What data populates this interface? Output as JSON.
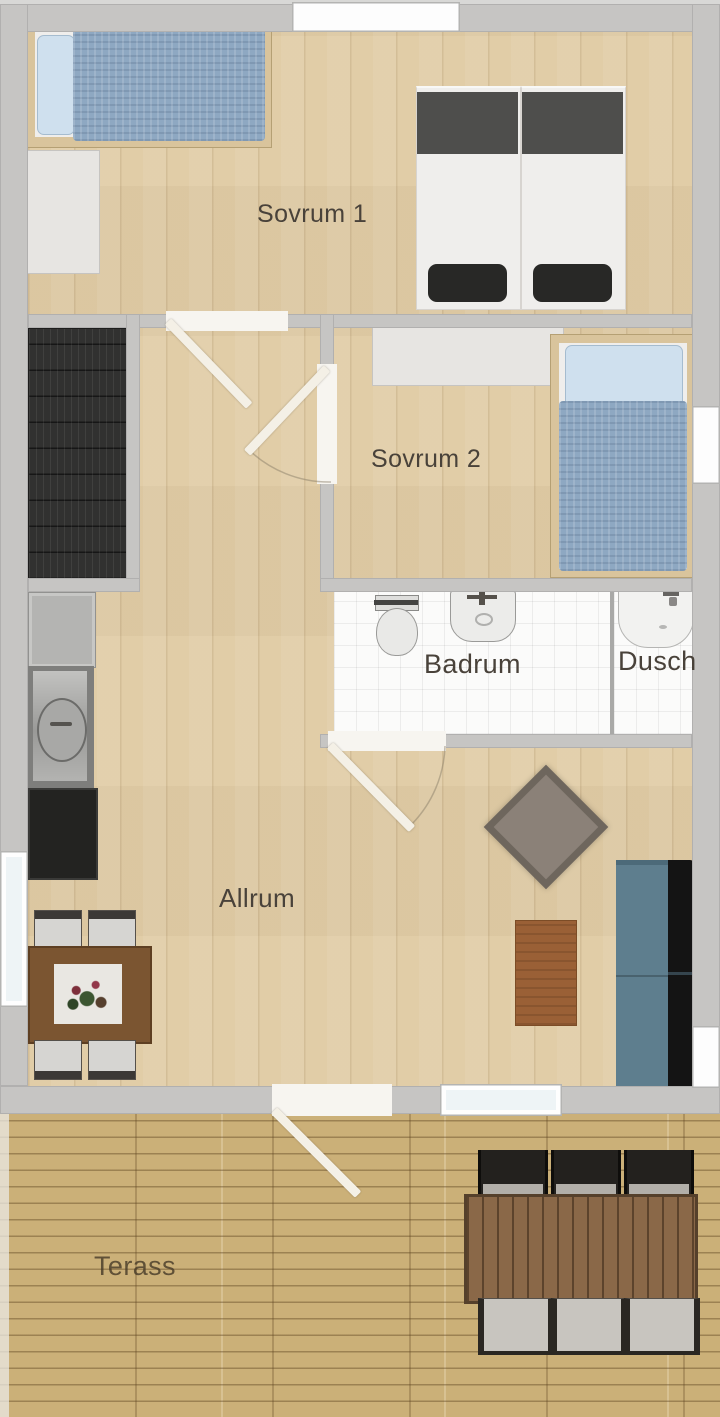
{
  "plan_title": "Apartment floor plan",
  "rooms": {
    "sovrum1": {
      "label": "Sovrum 1"
    },
    "sovrum2": {
      "label": "Sovrum 2"
    },
    "badrum": {
      "label": "Badrum"
    },
    "dusch": {
      "label": "Dusch"
    },
    "allrum": {
      "label": "Allrum"
    },
    "terass": {
      "label": "Terass"
    }
  },
  "colors": {
    "wall_gray": "#c6c5c3",
    "floor_wood": "#e1cda7",
    "terrace_wood": "#cbb078",
    "bathroom_tile": "#fbfbfa",
    "bed_duvet_blue": "#8ea8c2",
    "bed_pillow_blue": "#cfe0ee",
    "twin_duvet_dark": "#4e4e4c",
    "staircase_dark": "#313130",
    "sofa_seat_teal": "#5e7e8e",
    "sofa_back_black": "#141414",
    "dining_table_brown": "#7b5531",
    "coffee_table_brown": "#9a6036",
    "outdoor_table_brown": "#8a6848",
    "door_leaf": "#f4f0e6",
    "label_text": "#49423a"
  },
  "objects": {
    "staircase": "staircase",
    "sovrum1_single_bed": "single-bed",
    "sovrum1_twin_beds": "twin-beds",
    "sovrum1_dresser": "dresser",
    "sovrum2_dresser": "dresser",
    "sovrum2_bed": "single-bed",
    "toilet": "toilet",
    "washbasin": "washbasin",
    "shower": "shower",
    "kitchen": "counter-sink-stove",
    "dining_set": "table-with-flowers-4-chairs",
    "ottoman": "ottoman",
    "coffee_table": "coffee-table",
    "sofa": "sofa",
    "outdoor_set": "table-6-chairs",
    "doors": "4-door-swings",
    "windows": "6-windows"
  }
}
